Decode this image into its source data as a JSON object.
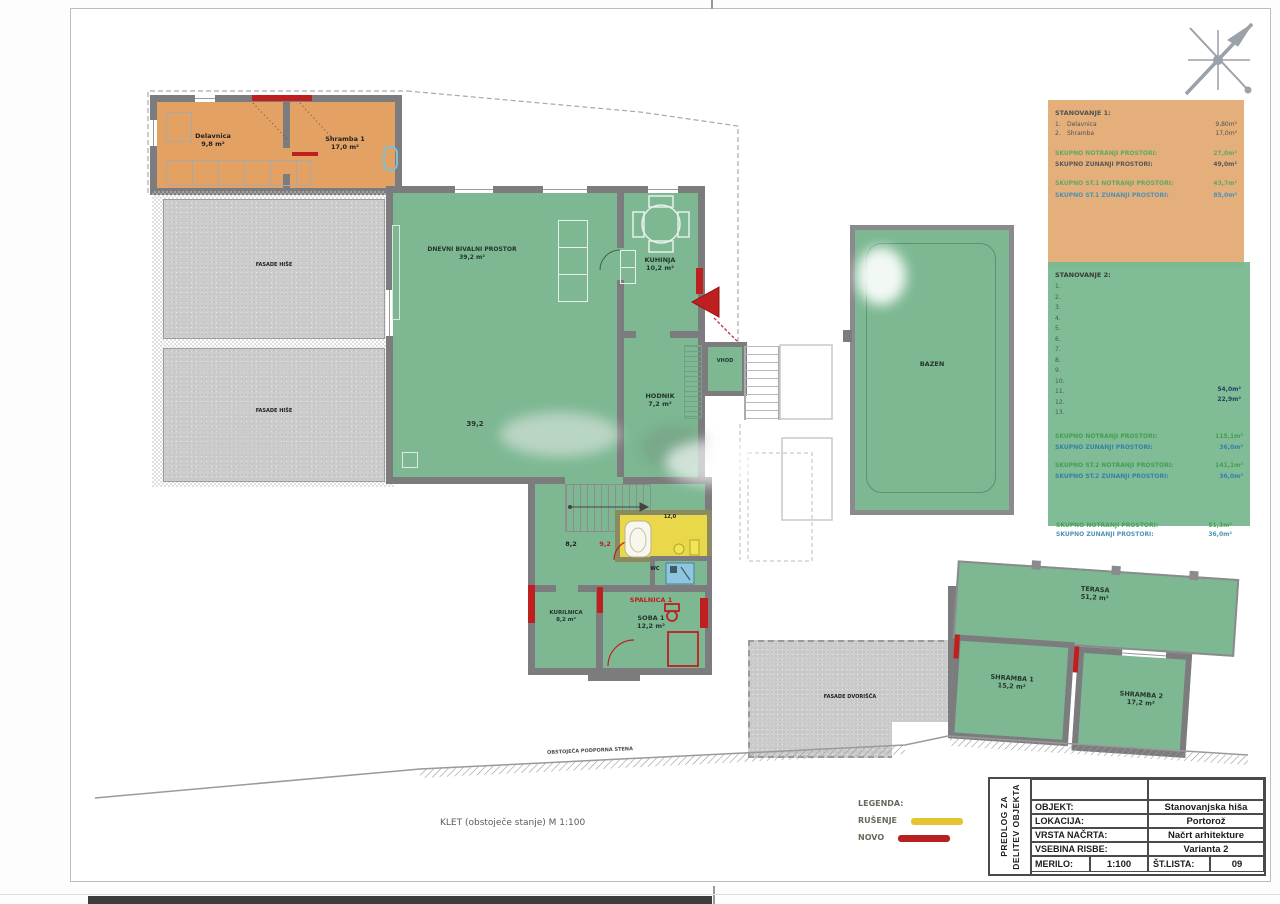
{
  "sheet_caption": "KLET (obstoječe stanje) M 1:100",
  "retaining_wall_label": "OBSTOJEČA PODPORNA STENA",
  "apartment1_box": {
    "title": "STANOVANJE 1:",
    "items": [
      {
        "num": "1.",
        "name": "Delavnica",
        "area": "9,80m²"
      },
      {
        "num": "2.",
        "name": "Shramba",
        "area": "17,0m²"
      }
    ],
    "summary": [
      {
        "label": "SKUPNO NOTRANJI PROSTORI:",
        "value": "27,0m²"
      },
      {
        "label": "SKUPNO ZUNANJI PROSTORI:",
        "value": "49,0m²"
      },
      {
        "label": "SKUPNO ST.1 NOTRANJI PROSTORI:",
        "value": "43,7m²"
      },
      {
        "label": "SKUPNO ST.1 ZUNANJI PROSTORI:",
        "value": "85,0m²"
      }
    ]
  },
  "apartment2_box": {
    "title": "STANOVANJE 2:",
    "items": [
      "1.",
      "2.",
      "3.",
      "4.",
      "5.",
      "6.",
      "7.",
      "8.",
      "9.",
      "10.",
      "11.",
      "12.",
      "13."
    ],
    "areas": [
      "54,0m²",
      "22,9m²"
    ],
    "summary": [
      {
        "label": "SKUPNO NOTRANJI PROSTORI:",
        "value": "115,1m²"
      },
      {
        "label": "SKUPNO ZUNANJI PROSTORI:",
        "value": "36,0m²"
      },
      {
        "label": "SKUPNO ST.2 NOTRANJI PROSTORI:",
        "value": "141,1m²"
      },
      {
        "label": "SKUPNO ST.2 ZUNANJI PROSTORI:",
        "value": "36,0m²"
      }
    ]
  },
  "totals": [
    {
      "label": "SKUPNO NOTRANJI PROSTORI:",
      "value": "51,3m²"
    },
    {
      "label": "SKUPNO ZUNANJI PROSTORI:",
      "value": "36,0m²"
    }
  ],
  "plan": {
    "rooms": {
      "delavnica": {
        "name": "Delavnica",
        "area": "9,8 m²"
      },
      "shramba1": {
        "name": "Shramba 1",
        "area": "17,0 m²"
      },
      "fasada_a": {
        "name": "FASADE HIŠE"
      },
      "fasada_b": {
        "name": "FASADE HIŠE"
      },
      "dnevni": {
        "name": "DNEVNI BIVALNI PROSTOR",
        "area": "39,2 m²",
        "area_mark": "39,2"
      },
      "kuhinja": {
        "name": "KUHINJA",
        "area": "10,2 m²"
      },
      "hodnik": {
        "name": "HODNIK",
        "area": "7,2 m²"
      },
      "vhod": {
        "name": "VHOD"
      },
      "kopalnica_area": "12,0",
      "wc": {
        "name": "WC"
      },
      "pralnica_old": "8,2",
      "pralnica_new": "9,2",
      "kurilnica": {
        "name": "KURILNICA",
        "area": "8,2 m²"
      },
      "spalnica_new": "SPALNICA 1",
      "soba1": {
        "name": "SOBA 1",
        "area": "12,2 m²"
      },
      "bazen": {
        "name": "BAZEN"
      },
      "terasa": {
        "name": "TERASA",
        "area": "51,2 m²"
      },
      "shramba_t1": {
        "name": "SHRAMBA 1",
        "area": "15,2 m²"
      },
      "shramba_t2": {
        "name": "SHRAMBA 2",
        "area": "17,2 m²"
      },
      "dvorisce": {
        "name": "FASADE DVORIŠČA"
      }
    }
  },
  "legend": {
    "title": "LEGENDA:",
    "items": [
      {
        "label": "RUŠENJE",
        "color": "#e3c52f"
      },
      {
        "label": "NOVO",
        "color": "#b92020"
      }
    ]
  },
  "title_block": {
    "side_line1": "PREDLOG ZA",
    "side_line2": "DELITEV OBJEKTA",
    "rows": [
      {
        "label": "OBJEKT:",
        "value": "Stanovanjska hiša"
      },
      {
        "label": "LOKACIJA:",
        "value": "Portorož"
      },
      {
        "label": "VRSTA NAČRTA:",
        "value": "Načrt arhitekture"
      },
      {
        "label": "VSEBINA RISBE:",
        "value": "Varianta 2"
      }
    ],
    "scale_label": "MERILO:",
    "scale_value": "1:100",
    "sheet_label": "ŠT.LISTA:",
    "sheet_value": "09"
  },
  "colors": {
    "existing_green": "#7db893",
    "apartment1_orange": "#e3a263",
    "wall_gray": "#7c7c7f",
    "new_red": "#b92020",
    "demolish_yellow": "#e8d84a"
  }
}
